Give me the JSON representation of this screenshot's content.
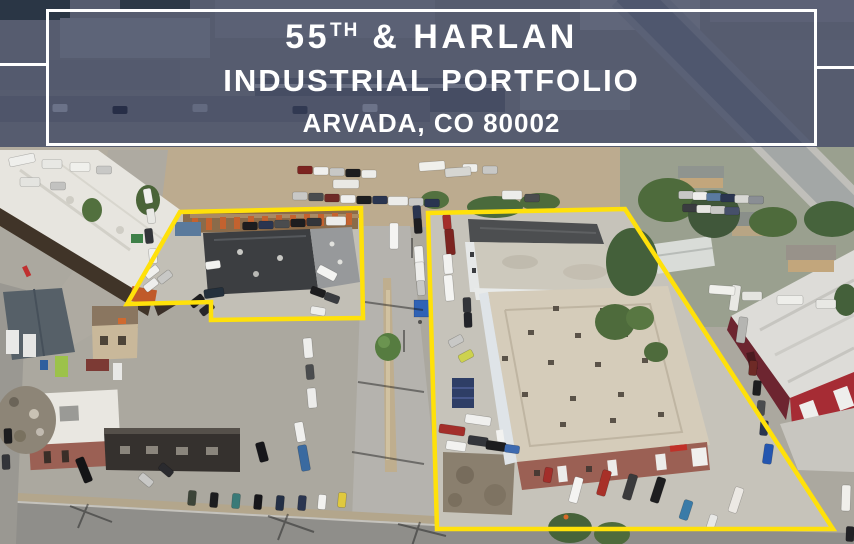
{
  "banner": {
    "line1": {
      "number": "55",
      "superscript": "TH",
      "rest": " & HARLAN"
    },
    "line2": "INDUSTRIAL PORTFOLIO",
    "line3": "ARVADA, CO 80002"
  },
  "colors": {
    "banner_overlay": "rgba(28,38,76,0.62)",
    "banner_border": "#ffffff",
    "banner_text": "#ffffff",
    "parcel_outline": "#ffe10a"
  },
  "scene": {
    "type": "aerial-photograph",
    "outlined_parcels": [
      "left-parcel",
      "right-parcel"
    ]
  }
}
